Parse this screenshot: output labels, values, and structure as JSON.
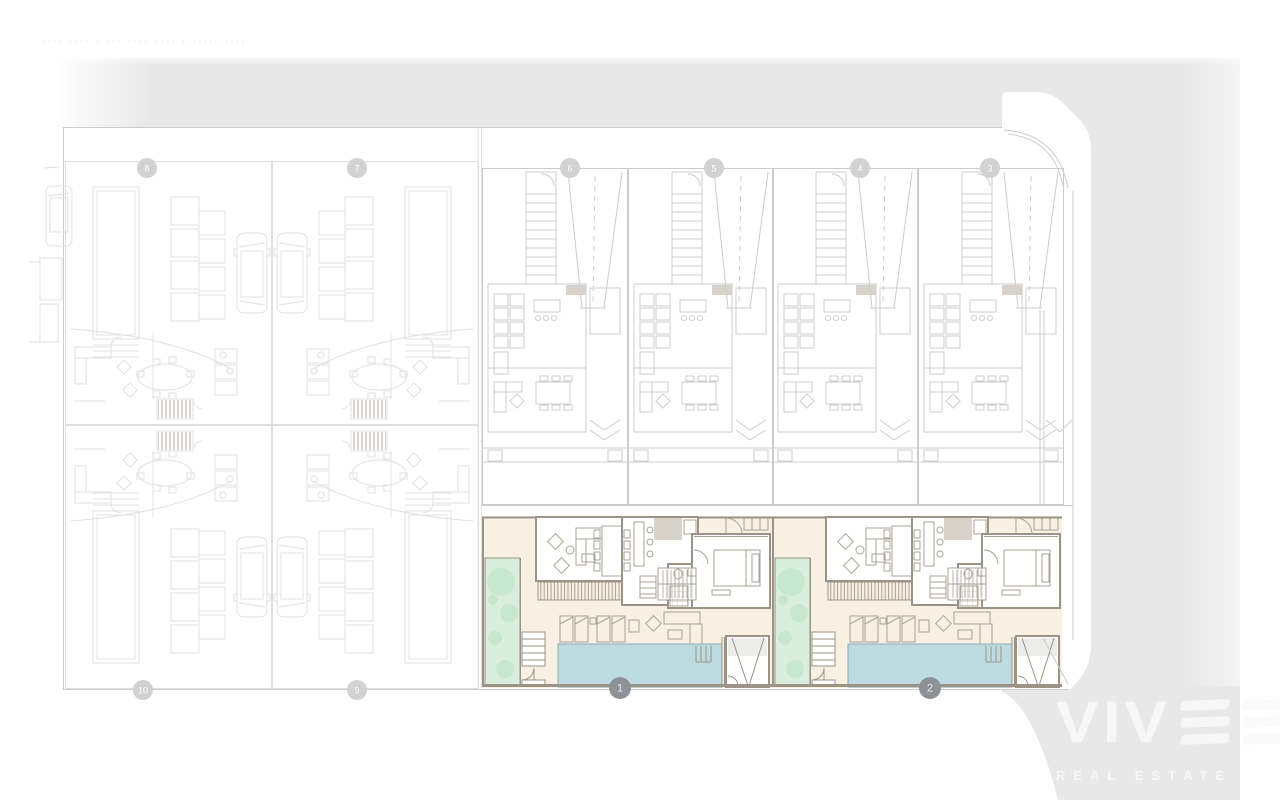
{
  "meta": {
    "drawing_title": "···· ···· · ··· ···· ···· · ····· ····"
  },
  "colors": {
    "road": "#e8e8e8",
    "title": "#c6c6c6",
    "plan_faint": "#e0e0e0",
    "plan_light": "#cccccc",
    "cream": "#f9f0e4",
    "wall": "#9b9385",
    "stub": "#d9d2cb",
    "pool": "#bddce2",
    "pool_edge": "#8aacb3",
    "garden": "#d9eedd",
    "tree": "#c4e6cc",
    "badge_light": "#d2d2d2",
    "badge_strong": "#8e9296",
    "logo": "#f7f7f7"
  },
  "site": {
    "unit_badges": [
      {
        "label": "8",
        "x": 147,
        "y": 168,
        "tone": "light"
      },
      {
        "label": "7",
        "x": 357,
        "y": 168,
        "tone": "light"
      },
      {
        "label": "6",
        "x": 570,
        "y": 168,
        "tone": "light"
      },
      {
        "label": "5",
        "x": 714,
        "y": 168,
        "tone": "light"
      },
      {
        "label": "4",
        "x": 860,
        "y": 168,
        "tone": "light"
      },
      {
        "label": "3",
        "x": 990,
        "y": 168,
        "tone": "light"
      },
      {
        "label": "10",
        "x": 143,
        "y": 690,
        "tone": "light"
      },
      {
        "label": "9",
        "x": 357,
        "y": 690,
        "tone": "light"
      },
      {
        "label": "1",
        "x": 620,
        "y": 688,
        "tone": "strong"
      },
      {
        "label": "2",
        "x": 930,
        "y": 688,
        "tone": "strong"
      }
    ],
    "highlighted_units": [
      "1",
      "2"
    ]
  },
  "logo": {
    "brand": "VIVE",
    "brand_letters": "VIV",
    "tagline": "REAL ESTATE"
  }
}
